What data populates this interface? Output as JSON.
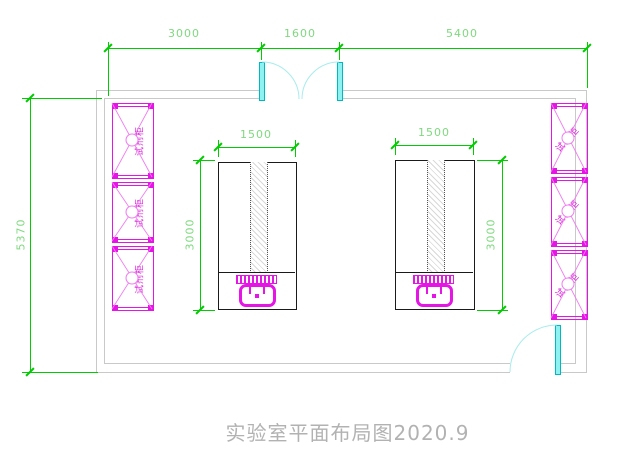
{
  "title": "实验室平面布局图2020.9",
  "dims": {
    "top": [
      "3000",
      "1600",
      "5400"
    ],
    "overall_height": "5370",
    "bench_left": {
      "width": "1500",
      "depth": "3000"
    },
    "bench_right": {
      "width": "1500",
      "depth": "3000"
    }
  },
  "cabinets": {
    "left": [
      "试剂柜",
      "试剂柜",
      "试剂柜"
    ],
    "right": [
      "试剂柜",
      "试剂柜",
      "试剂柜"
    ]
  },
  "colors": {
    "dimension_green": "#00cc00",
    "furniture_magenta": "#e515e5",
    "door_cyan": "#2ae0e8",
    "wall_gray": "#c9c9c9",
    "bench_outline": "#1a1a1a",
    "title_gray": "#b2b2b2"
  }
}
